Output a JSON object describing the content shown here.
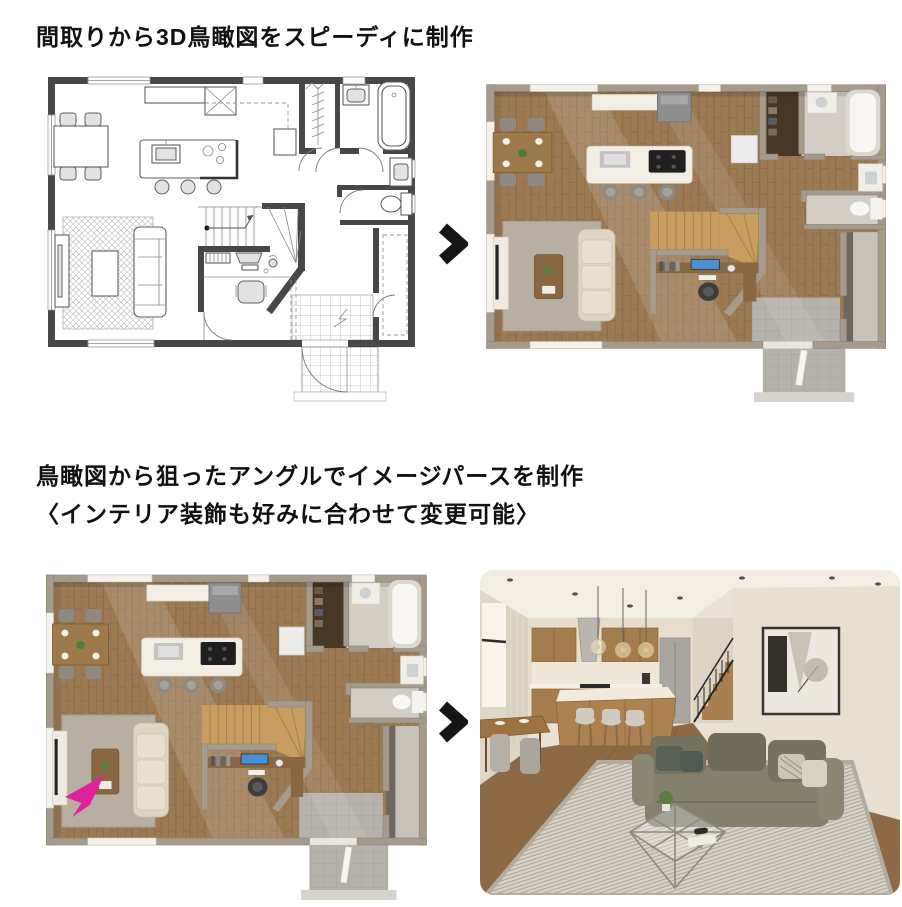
{
  "page": {
    "background": "#ffffff"
  },
  "step1": {
    "heading": "間取りから3D鳥瞰図をスピーディに制作"
  },
  "step2": {
    "heading_line1": "鳥瞰図から狙ったアングルでイメージパースを制作",
    "heading_line2": "〈インテリア装飾も好みに合わせて変更可能〉"
  },
  "icons": {
    "arrow_right": "chevron-right",
    "camera_direction": "arrow-up-right"
  },
  "colors": {
    "heading_text": "#111111",
    "arrow": "#151515",
    "camera_arrow": "#e0219e",
    "plan_wall": "#474747",
    "render_wall": "#a49b8d",
    "render_floor_wood": "#9b7a54",
    "render_rug": "#b7afa1",
    "perspective_sofa": "#83806c",
    "perspective_rug": "#d7d2c7"
  }
}
